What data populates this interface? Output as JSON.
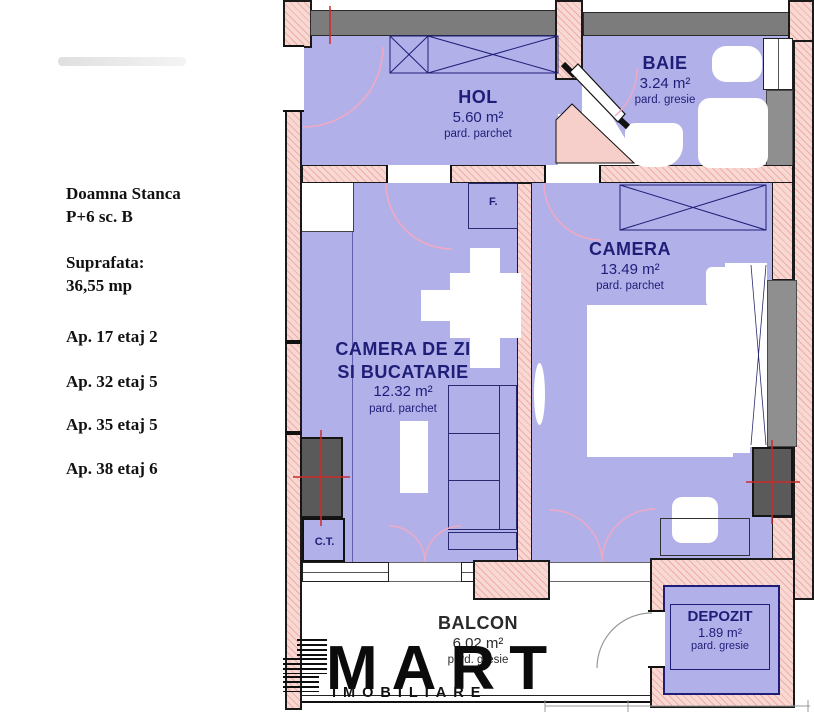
{
  "info_panel": {
    "address_line1": "Doamna Stanca",
    "address_line2": "P+6 sc. B",
    "surface_label": "Suprafata:",
    "surface_value": "36,55 mp",
    "apartments": [
      "Ap. 17 etaj 2",
      "Ap. 32 etaj 5",
      "Ap. 35 etaj 5",
      "Ap. 38 etaj 6"
    ]
  },
  "rooms": {
    "hol": {
      "name": "HOL",
      "area": "5.60 m²",
      "floor": "pard. parchet"
    },
    "baie": {
      "name": "BAIE",
      "area": "3.24 m²",
      "floor": "pard. gresie"
    },
    "camera": {
      "name": "CAMERA",
      "area": "13.49 m²",
      "floor": "pard. parchet"
    },
    "living": {
      "name_line1": "CAMERA DE ZI",
      "name_line2": "SI BUCATARIE",
      "area": "12.32 m²",
      "floor": "pard. parchet"
    },
    "balcon": {
      "name": "BALCON",
      "area": "6.02 m²",
      "floor": "pard. gresie"
    },
    "depozit": {
      "name": "DEPOZIT",
      "area": "1.89 m²",
      "floor": "pard. gresie"
    },
    "ct": {
      "label": "C.T."
    },
    "f": {
      "label": "F."
    }
  },
  "logo": {
    "brand": "MART",
    "tagline": "IMOBILIARE"
  },
  "colors": {
    "room_fill": "#b2b0e9",
    "wall_pink": "#f8d8d3",
    "wall_gray": "#7c7c7c",
    "shaft_gray": "#5a5a5a",
    "label_navy": "#1e1e78",
    "cross_red": "#cc2a2a",
    "door_arc_pink": "#f0a9c4"
  }
}
